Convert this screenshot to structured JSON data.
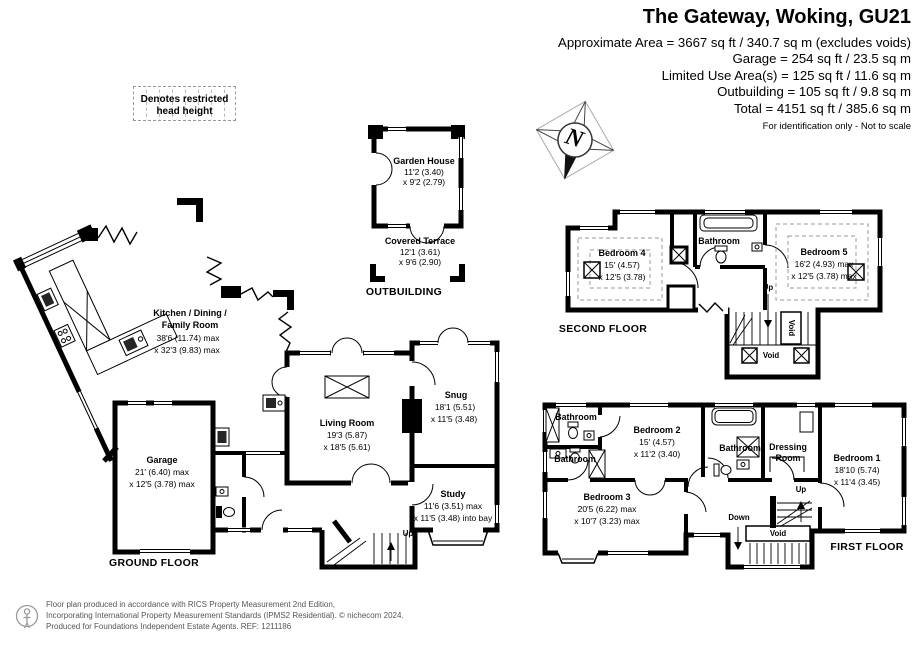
{
  "header": {
    "title": "The Gateway, Woking, GU21",
    "line1": "Approximate Area = 3667 sq ft / 340.7 sq m (excludes voids)",
    "line2": "Garage = 254 sq ft / 23.5 sq m",
    "line3": "Limited Use Area(s) = 125 sq ft / 11.6 sq m",
    "line4": "Outbuilding = 105 sq ft / 9.8 sq m",
    "line5": "Total = 4151 sq ft / 385.6 sq m",
    "disclaimer": "For identification only - Not to scale"
  },
  "legend": {
    "line1": "Denotes restricted",
    "line2": "head height"
  },
  "compass": {
    "letter": "N"
  },
  "outbuilding": {
    "label": "OUTBUILDING",
    "garden_house": {
      "name": "Garden House",
      "dim1": "11'2 (3.40)",
      "dim2": "x 9'2 (2.79)"
    },
    "covered_terrace": {
      "name": "Covered Terrace",
      "dim1": "12'1 (3.61)",
      "dim2": "x 9'6 (2.90)"
    }
  },
  "ground_floor": {
    "label": "GROUND FLOOR",
    "kitchen": {
      "name1": "Kitchen / Dining /",
      "name2": "Family Room",
      "dim1": "38'6 (11.74) max",
      "dim2": "x 32'3 (9.83) max"
    },
    "living_room": {
      "name": "Living Room",
      "dim1": "19'3 (5.87)",
      "dim2": "x 18'5 (5.61)"
    },
    "snug": {
      "name": "Snug",
      "dim1": "18'1 (5.51)",
      "dim2": "x 11'5 (3.48)"
    },
    "study": {
      "name": "Study",
      "dim1": "11'6 (3.51) max",
      "dim2": "x 11'5 (3.48) into bay"
    },
    "garage": {
      "name": "Garage",
      "dim1": "21' (6.40) max",
      "dim2": "x 12'5 (3.78) max"
    },
    "up": "Up"
  },
  "second_floor": {
    "label": "SECOND FLOOR",
    "bedroom4": {
      "name": "Bedroom 4",
      "dim1": "15' (4.57)",
      "dim2": "x 12'5 (3.78)"
    },
    "bedroom5": {
      "name": "Bedroom 5",
      "dim1": "16'2 (4.93) max",
      "dim2": "x 12'5 (3.78) max"
    },
    "bathroom": "Bathroom",
    "up": "Up",
    "void_stair": "Void",
    "void": "Void"
  },
  "first_floor": {
    "label": "FIRST FLOOR",
    "bedroom1": {
      "name": "Bedroom 1",
      "dim1": "18'10 (5.74)",
      "dim2": "x 11'4 (3.45)"
    },
    "bedroom2": {
      "name": "Bedroom 2",
      "dim1": "15' (4.57)",
      "dim2": "x 11'2 (3.40)"
    },
    "bedroom3": {
      "name": "Bedroom 3",
      "dim1": "20'5 (6.22) max",
      "dim2": "x 10'7 (3.23) max"
    },
    "bathroom1": "Bathroom",
    "bathroom2": "Bathroom",
    "bathroom3": "Bathroom",
    "dressing_room": {
      "line1": "Dressing",
      "line2": "Room"
    },
    "up": "Up",
    "down": "Down",
    "void": "Void"
  },
  "footer": {
    "line1": "Floor plan produced in accordance with RICS Property Measurement 2nd Edition,",
    "line2": "Incorporating International Property Measurement Standards (IPMS2 Residential).    © nichecom 2024.",
    "line3": "Produced for Foundations Independent Estate Agents.    REF: 1211186"
  }
}
